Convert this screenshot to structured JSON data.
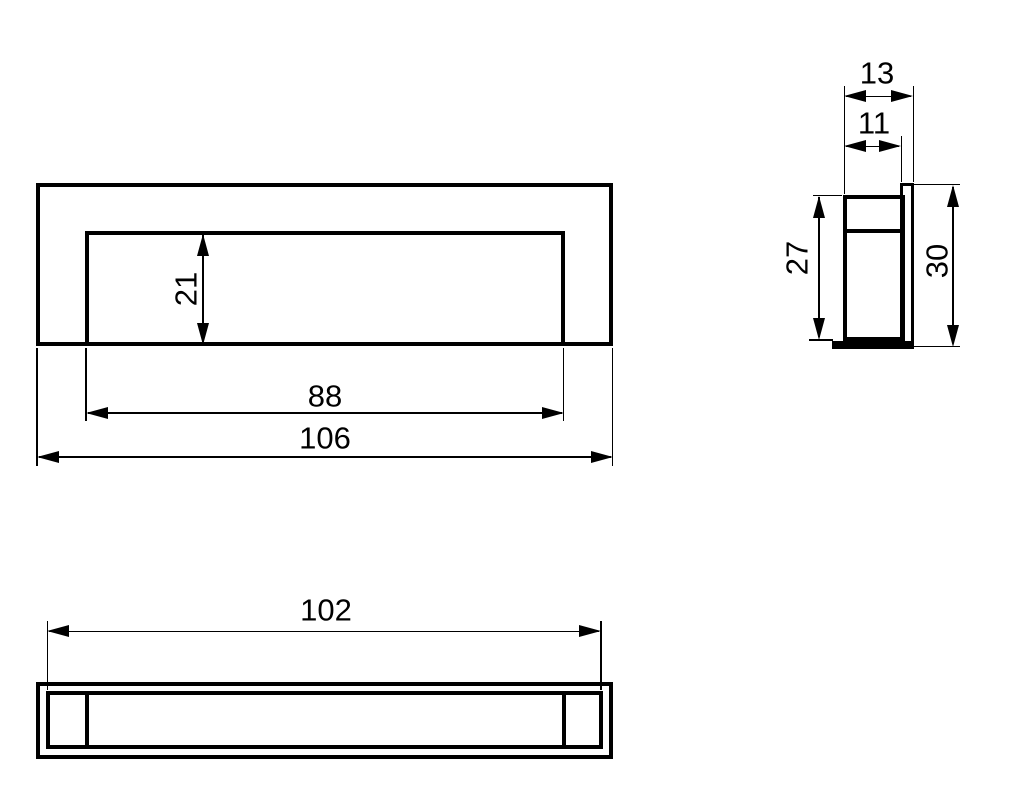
{
  "drawing": {
    "kind": "technical-dimension-drawing",
    "subject": "recessed flush pull handle, three orthographic views",
    "ink_color": "#000000",
    "background_color": "#ffffff"
  },
  "dims": {
    "front_recess_height": "21",
    "front_recess_width": "88",
    "front_overall_width": "106",
    "side_overall_depth": "13",
    "side_recess_depth": "11",
    "side_recess_height": "27",
    "side_overall_height": "30",
    "bottom_recess_width": "102"
  }
}
